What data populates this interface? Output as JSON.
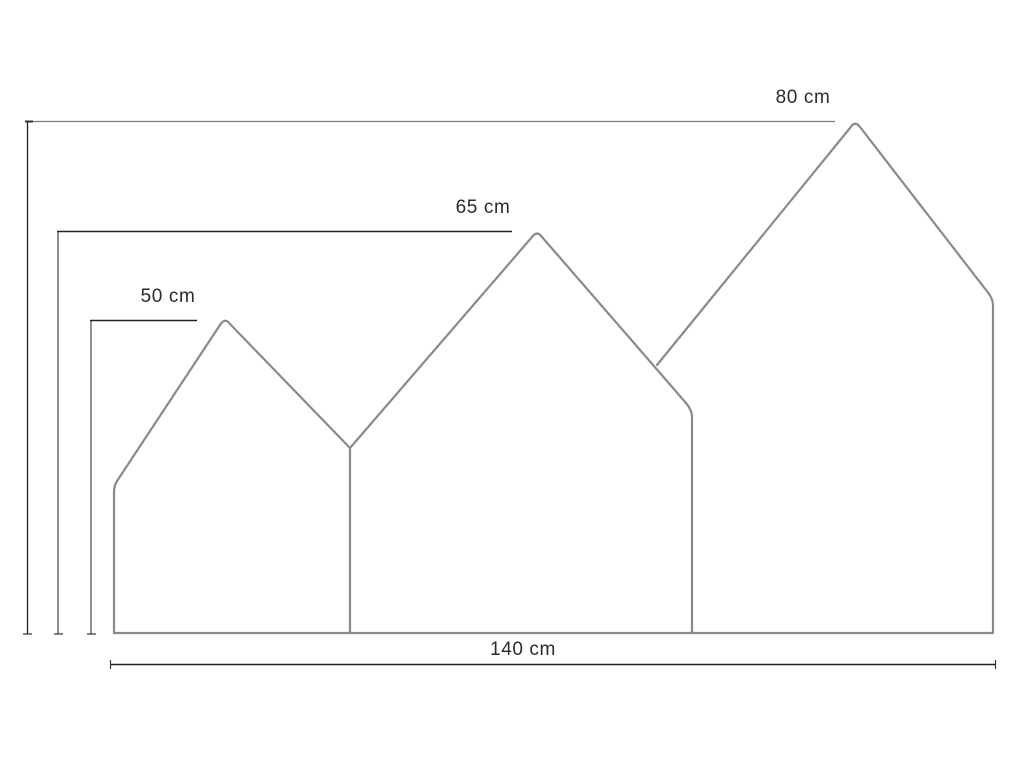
{
  "diagram": {
    "type": "dimensioned-line-drawing",
    "subject": "three-house-shaped-panel-outline",
    "dimension_labels": {
      "house_large_height": "80 cm",
      "house_medium_height": "65 cm",
      "house_small_height": "50 cm",
      "total_width": "140 cm"
    },
    "values_cm": {
      "house_large_height": 80,
      "house_medium_height": 65,
      "house_small_height": 50,
      "total_width": 140
    },
    "colors": {
      "outline": "#8a8a8a",
      "extension_line": "#8f8f8f",
      "dimension_line_dark": "#222222",
      "dimension_line_soft": "#7d7d7d",
      "tick": "#333333",
      "text": "#2b2b2b",
      "background": "#ffffff"
    }
  }
}
